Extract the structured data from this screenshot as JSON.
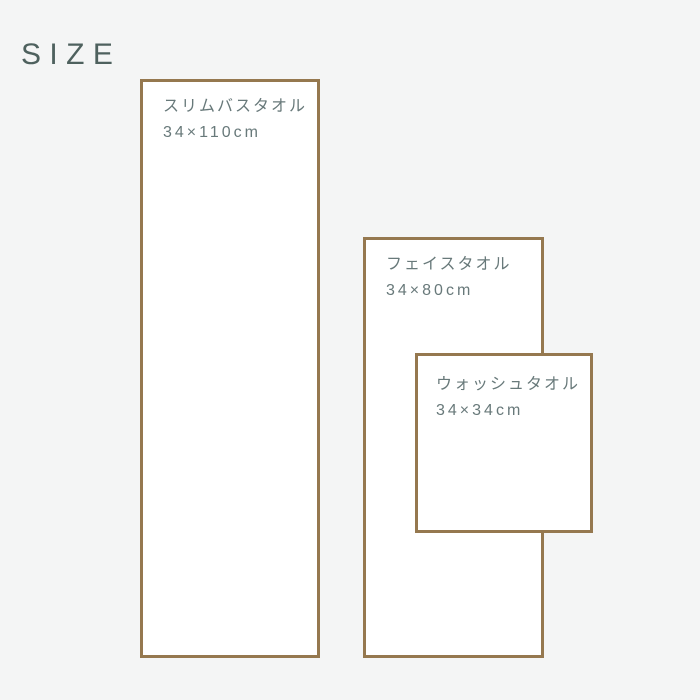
{
  "page": {
    "title": "SIZE",
    "background_color": "#f4f5f5",
    "title_color": "#4e615e"
  },
  "diagram": {
    "border_color": "#95784f",
    "fill_color": "#ffffff",
    "label_color": "#68797a",
    "items": [
      {
        "name": "スリムバスタオル",
        "size": "34×110cm"
      },
      {
        "name": "フェイスタオル",
        "size": "34×80cm"
      },
      {
        "name": "ウォッシュタオル",
        "size": "34×34cm"
      }
    ]
  }
}
